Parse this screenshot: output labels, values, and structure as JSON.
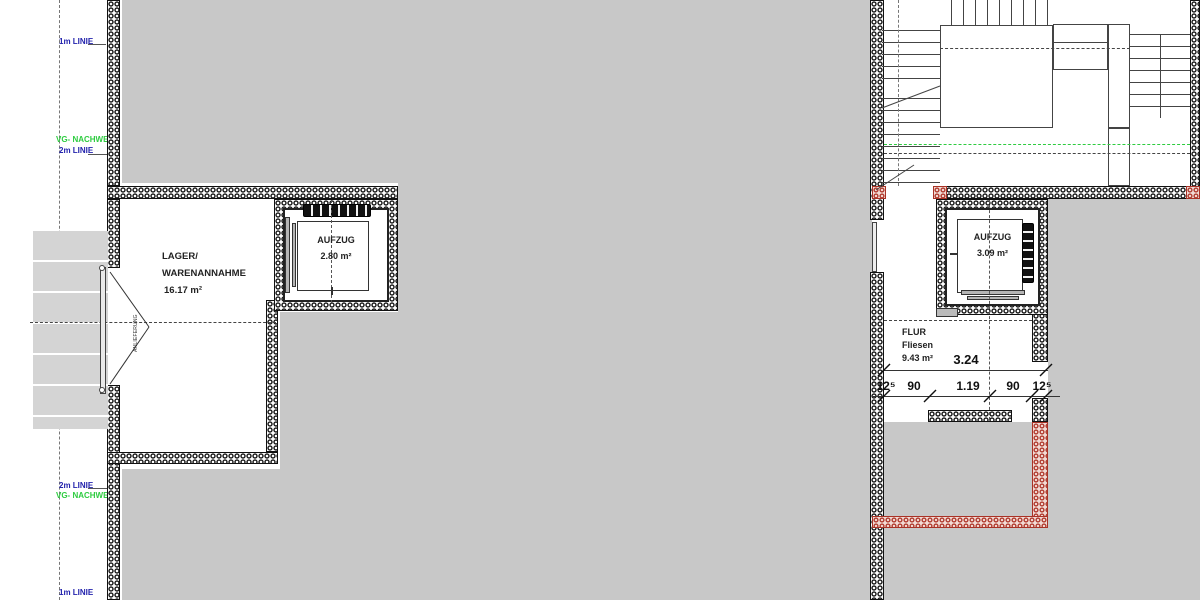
{
  "drawing": {
    "kind": "architectural floor plan (German)",
    "guide_labels": {
      "top_1m": "1m LINIE",
      "top_vg": "VG- NACHWEIS",
      "top_2m": "2m LINIE",
      "bottom_2m": "2m LINIE",
      "bottom_vg": "VG- NACHWEIS",
      "bottom_1m": "1m LINIE"
    },
    "rooms": {
      "lager": {
        "name_line1": "LAGER/",
        "name_line2": "WARENANNAHME",
        "area": "16.17 m²"
      },
      "aufzug_left": {
        "name": "AUFZUG",
        "area": "2.80 m²"
      },
      "aufzug_right": {
        "name": "AUFZUG",
        "area": "3.09 m²"
      },
      "flur": {
        "name": "FLUR",
        "finish": "Fliesen",
        "area": "9.43 m²"
      }
    },
    "dimensions": {
      "overall": "3.24",
      "chain": [
        "12⁵",
        "90",
        "1.19",
        "90",
        "12⁵"
      ]
    },
    "door_annotation": "ANLIEFERUNG",
    "colors": {
      "mask_gray": "#c8c8c8",
      "guide_blue": "#2323ad",
      "guide_green": "#2ecc40",
      "wall_red": "#b03a2e"
    }
  }
}
